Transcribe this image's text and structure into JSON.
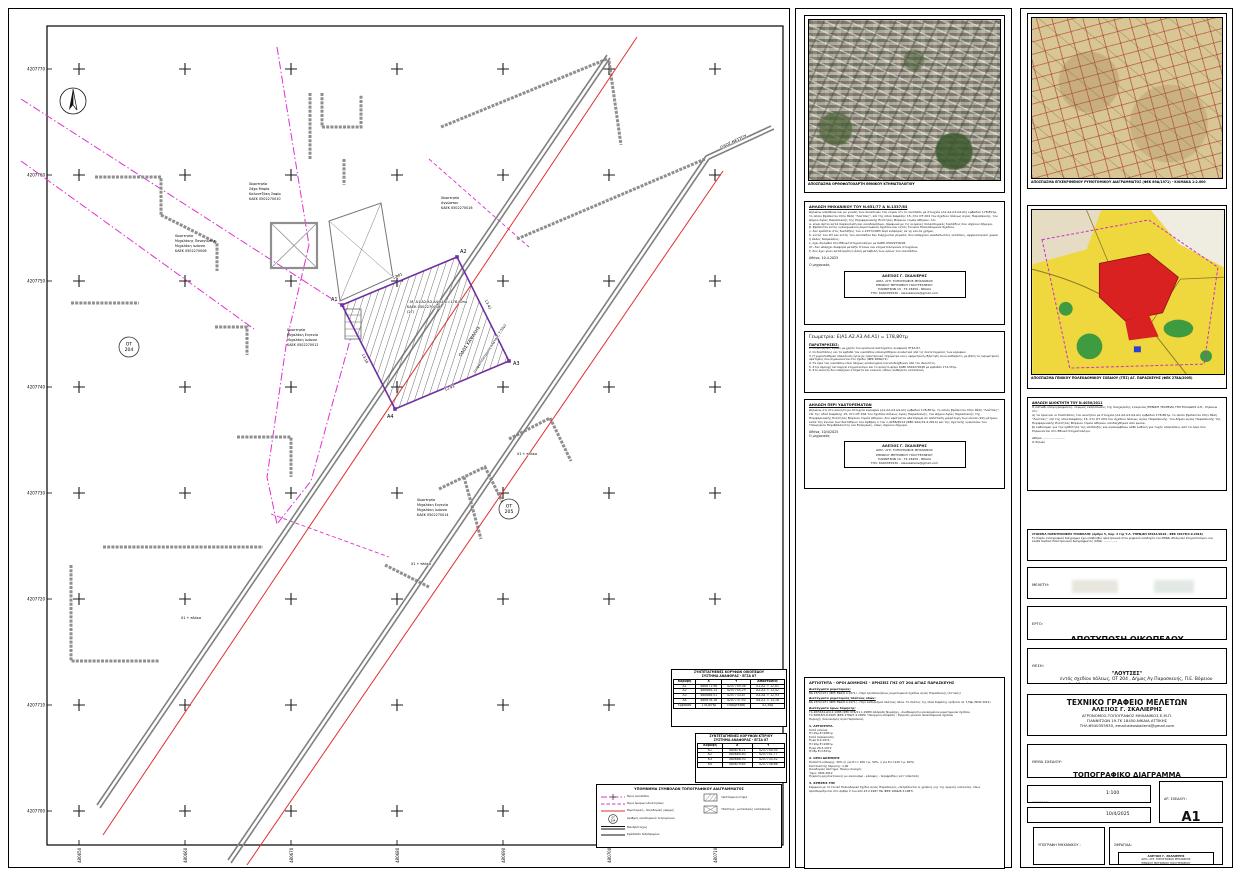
{
  "plan": {
    "y_ticks": [
      "4207770",
      "4207760",
      "4207750",
      "4207740",
      "4207730",
      "4207720",
      "4207710",
      "4207700"
    ],
    "x_ticks": [
      "480650",
      "480660",
      "480670",
      "480680",
      "480690",
      "480700",
      "480710"
    ],
    "ot1": {
      "l1": "ΟΤ",
      "l2": "204"
    },
    "ot2": {
      "l1": "ΟΤ",
      "l2": "205"
    },
    "vertices": [
      "Α1",
      "Α2",
      "Α3",
      "Α4"
    ],
    "dims": [
      "12,81",
      "13,42",
      "12,93",
      "13,18"
    ],
    "levels": [
      "Χ1 + πλάκα",
      "Χ1 + πλάκα",
      "Χ1 + πλάκα"
    ],
    "roads": {
      "r1": "ΟΔΟΣ ΚΑΨΑΛΗΣ",
      "r2": "(ασφαλτόστρωτη πλάτους 7,50μ)",
      "r3": "ΟΔΟΣ ΝΕΣΤΟΥ"
    },
    "plot": {
      "l1": "Γ.Μ. Α1.Α2.Α3.Α4.Α1 Ε=178,80τμ",
      "l2": "ΚΑΕΚ 0502270018",
      "l3": "(2Γ)"
    },
    "props": {
      "p10": [
        "Ιδιοκτησία",
        "Σάχα Μαρία",
        "Καλαντζάκη Σοφία",
        "ΚΑΕΚ 0502270010"
      ],
      "p08": [
        "Ιδιοκτησία",
        "Μιχαλάκης Παναγιώτης",
        "Μιχαλάκη Ιωάννα",
        "ΚΑΕΚ 0502270008"
      ],
      "p16": [
        "Ιδιοκτησία",
        "Αγνώστου",
        "ΚΑΕΚ 0502270016"
      ],
      "p12": [
        "Ιδιοκτησία",
        "Μιχαλάκη Ευγενία",
        "Μιχαλάκη Ιωάννα",
        "ΚΑΕΚ 0502270012"
      ],
      "p14": [
        "Ιδιοκτησία",
        "Μιχαλάκη Ευγενία",
        "Μιχαλάκη Ιωάννα",
        "ΚΑΕΚ 0502270014"
      ]
    },
    "legend": {
      "title": "ΥΠΟΜΝΗΜΑ ΣΥΜΒΟΛΩΝ ΤΟΠΟΓΡΑΦΙΚΟΥ ΔΙΑΓΡΑΜΜΑΤΟΣ",
      "items": [
        "Όρια οικοπέδου",
        "Όρια όμορων ιδιοκτησιών",
        "Ρυμοτομική - Οικοδομική γραμμή",
        "Αριθμός οικοδομικού τετραγώνου",
        "Μανδρότοιχος",
        "Κράσπεδο πεζοδρομίου",
        "Υφιστάμενα κτίρια",
        "Υπόστεγα - μεταλλικές κατασκευές"
      ]
    },
    "t1": {
      "title1": "ΣΥΝΤΕΤΑΓΜΕΝΕΣ ΚΟΡΥΦΩΝ ΟΙΚΟΠΕΔΟΥ",
      "title2": "ΣΥΣΤΗΜΑ ΑΝΑΦΟΡΑΣ - ΕΓΣΑ 87",
      "h": [
        "Κορυφή",
        "Χ",
        "Υ",
        "Αποστάσεις"
      ],
      "rows": [
        [
          "Α1",
          "480671.98",
          "4207749.36",
          "Α1-Α2 = 12,81"
        ],
        [
          "Α2",
          "480684.13",
          "4207745.29",
          "Α2-Α3 = 13,42"
        ],
        [
          "Α3",
          "480688.51",
          "4207733.87",
          "Α3-Α4 = 12,93"
        ],
        [
          "Α4",
          "480676.16",
          "4207737.93",
          "Α4-Α1 = 13,18"
        ]
      ],
      "f": [
        "Εμβαδόν",
        "178,80τμ",
        "Περίμετρος",
        "52,34μ"
      ]
    },
    "t2": {
      "title1": "ΣΥΝΤΕΤΑΓΜΕΝΕΣ ΚΟΡΥΦΩΝ ΚΤΙΡΙΟΥ",
      "title2": "ΣΥΣΤΗΜΑ ΑΝΑΦΟΡΑΣ - ΕΓΣΑ 87",
      "h": [
        "Κορυφή",
        "Χ",
        "Υ"
      ],
      "rows": [
        [
          "Κ1",
          "480676.21",
          "4207744.95"
        ],
        [
          "Κ2",
          "480684.60",
          "4207741.77"
        ],
        [
          "Κ3",
          "480688.93",
          "4207735.52"
        ],
        [
          "Κ4",
          "480679.85",
          "4207738.66"
        ]
      ]
    }
  },
  "mid": {
    "photo_caption": "ΑΠΟΣΠΑΣΜΑ ΟΡΘΟΦΩΤΟΧΑΡΤΗ ΕΘΝΙΚΟΥ ΚΤΗΜΑΤΟΛΟΓΙΟΥ",
    "d1": {
      "title": "ΔΗΛΩΣΗ ΜΗΧΑΝΙΚΟΥ ΤΟΥ Ν.651/77 & Ν.1337/83",
      "body": "Δηλώνω υπεύθυνα και με γνώση των συνεπειών του νόμου ότι το οικόπεδο με στοιχεία (Α1.Α2.Α3.Α4.Α1) εμβαδού 178,80τμ, το οποίο βρίσκεται στην θέση \"Λούτσες\", επί της οδού Καψάλης 15, στο ΟΤ 204 του σχεδίου πόλεως Αγίας Παρασκευής, του Δήμου Αγίας Παρασκευής της Περιφερειακής Ενότητας Βόρειου τομέα Αθηνών, ότι:\nα. είναι άρτιο κατά παρέκκλιση και οικοδομήσιμο, σύμφωνα με τις κείμενες πολεοδομικές διατάξεις που ισχύουν σήμερα,\nβ. βρίσκεται εντός εγκεκριμένου ρυμοτομικού σχεδίου και εντός Γενικού Πολεοδομικού Σχεδίου,\nγ. δεν εμπίπτει στις διατάξεις του ν.1337/1983 περί εισφοράς σε γη και σε χρήμα,\nδ. εντός του ΟΤ και εντός του οικοπέδου δεν διέρχονται ρέματα, δεν υπάρχουν αναδασωτέες εκτάσεις, αρχαιολογικοί χώροι ή άλλες δεσμεύσεις,\nε. έχει δηλωθεί στο Εθνικό Κτηματολόγιο με ΚΑΕΚ 0502270018,\nστ. δεν υπάρχει διαφορά μεταξύ τίτλων και κτηματολογικών στοιχείων,\nζ. δεν έχει γίνει κατάτμηση ή άλλη μεταβολή των ορίων του οικοπέδου.",
      "date": "Αθήνα, 10.4.2025",
      "signer": "Ο μηχανικός"
    },
    "stamp": [
      "ΑΛΕΞΙΟΣ Γ. ΣΚΑΛΙΕΡΗΣ",
      "ΔΙΠΛ. ΑΓΡ. ΤΟΠΟΓΡΑΦΟΣ ΜΗΧΑΝΙΚΟΣ",
      "ΕΘΝΙΚΟΥ ΜΕΤΣΟΒΙΟΥ ΠΟΛΥΤΕΧΝΕΙΟΥ",
      "ΓΙΑΝΝΙΤΣΩΝ 19 - ΤΚ 18450 - ΝΙΚΑΙΑ",
      "ΤΗΛ: 6940355930 - alexskalieris@gmail.com"
    ],
    "geo": {
      "title": "Γεωμετρία: Ε(Α1.Α2.Α3.Α4.Α1) = 178,80τμ",
      "nt": "ΠΑΡΑΤΗΡΗΣΕΙΣ:",
      "notes": "1. Οι μετρήσεις έγιναν με χρήση του κρατικού συστήματος αναφοράς ΕΓΣΑ-87.\n2. Οι διαστάσεις και τα εμβαδά του οικοπέδου υπολογίσθηκαν αναλυτικά από τις συντεταγμένες των κορυφών.\n3. Η χωροσταθμική απεικόνιση έγινε με ηλεκτρονικό ταχύμετρο και η υψομετρική εξάρτηση είναι αυθαίρετη, με βάση τις υψομετρικές αφετηρίες που σημειώνονται στο σχέδιο (ΦΕΚ 268Δ/71).\n4. Τα όρια του οικοπέδου είναι πλήρως υλοποιημένα και υποδείχθηκαν από τον ιδιοκτήτη.\n5. Στην περιοχή λειτουργεί κτηματολόγιο και το ακίνητο φέρει ΚΑΕΚ 0502270018 με εμβαδόν 174,33τμ.\n6. Στο ακίνητο δεν υπάρχουν κτίσματα και κανενός είδους αυθαίρετη κατασκευή."
    },
    "d2": {
      "title": "ΔΗΛΩΣΗ ΠΕΡΙ ΥΔΑΤΟΡΕΜΑΤΩΝ",
      "body": "Δηλώνω ότι στο ακίνητο με στοιχεία κορυφών (Α1.Α2.Α3.Α4.Α1) εμβαδού 178,80τμ, το οποίο βρίσκεται στην θέση \"Λούτσες\", επί της οδού Καψάλης 15, στο ΟΤ 204 του σχεδίου πόλεως Αγίας Παρασκευής, του Δήμου Αγίας Παρασκευής της Περιφερειακής Ενότητας Βόρειου τομέα Αθηνών, δεν υφίσταται υδατόρεμα σε απόσταση μικρότερη των είκοσι (20) μέτρων, κατά την έννοια των διατάξεων του άρθρου 1 του ν.4258/2014 (ΦΕΚ 94Α/14.4.2014) και της σχετικής εγκυκλίου του Υπουργείου Περιβάλλοντος και Ενέργειας, όπως ισχύουν σήμερα.",
      "date": "Αθήνα, 10/4/2025",
      "signer": "Ο μηχανικός"
    },
    "terms": {
      "title": "ΑΡΤΙΟΤΗΤΑ - ΟΡΟΙ ΔΟΜΗΣΗΣ - ΧΡΗΣΕΙΣ ΓΗΣ ΟΤ 204 ΑΓΙΑΣ ΠΑΡΑΣΚΕΥΗΣ",
      "s1h": "Διατάγματα ρυμοτομίας:",
      "s1b": "ΒΔ 23/5/1971 (ΦΕΚ 89Δ/8.4.1971) - Περί τροποποιήσεως ρυμοτομικού σχεδίου Αγίας Παρασκευής (Αττικής)",
      "s2h": "Διατάγματα ρυμοτομίας πλάτους οδών:",
      "s2b": "ΒΔ 23/5/1971 (ΦΕΚ 89Δ/8.4.1971) - Περί καθορισμού πλάτους οδών. Το πλάτος της οδού Καψάλης ορίζεται σε 7,50μ (ΝΟΚ 2012)",
      "s3h": "Διατάγματα όρων δόμησης:",
      "s3b": "ΥΑ 48/5634-Δ/9.2.1988 (ΦΕΚ 97Δ/11.1.1988) Απόφαση Νομάρχη - Αναθεώρηση εγκεκριμένου ρυμοτομικού σχεδίου\nΥΑ 26818/5.8.2005 (ΦΕΚ 278Δ/7.4.2005) Υπουργική απόφαση - Έγκριση γενικού πολεοδομικού σχεδίου\nΠεριοχή: Συνοικισμός Αγία Παρασκευή",
      "s4h": "1. ΑΡΤΙΟΤΗΤΑ.",
      "s4b": "Κατά κανόνα:\nΠ=15μ    Ε=400τμ\nΚατά παρέκκλιση:\nΈγκρ 8.4.1971:\nΠ=10μ    Ε=200τμ\nΈγκρ 26.3.1971:\nΠ=8μ     Ε=150τμ",
      "s5h": "2. ΟΡΟΙ ΔΟΜΗΣΗΣ",
      "s5b": "Ποσοστό κάλυψης: 30% (ή για Ε<= 200 τ.μ. 50%, ή για Ε<=120 τ.μ. 60%)\nΣυντελεστής δόμησης: 1,00\nΟικοδομικό σύστημα: Πρώην συνεχές\nΎψος: ΝΟΚ 2012\nΈγκριση αρχιτεκτονικής με κανονισμό - κάλυψης - περιφράξεις κατ' επέκταση",
      "s6h": "3. ΧΡΗΣΕΙΣ ΓΗΣ",
      "s6b": "Σύμφωνα με το Γενικό Πολεοδομικό Σχέδιο Αγίας Παρασκευής, επιτρέπονται οι χρήσεις γης της αμιγούς κατοικίας, όπως προσδιορίζονται στο άρθρο 2 του από 23.2.1987 ΠΔ (ΦΕΚ 166Δ/6.3.1987)."
    }
  },
  "right": {
    "cap1": "ΑΠΟΣΠΑΣΜΑ ΕΓΚΕΚΡΙΜΕΝΟΥ ΡΥΜΟΤΟΜΙΚΟΥ ΔΙΑΓΡΑΜΜΑΤΟΣ (ΦΕΚ 89Δ/1971) - ΚΛΙΜΑΚΑ 1:2.000",
    "cap2": "ΑΠΟΣΠΑΣΜΑ ΓΕΝΙΚΟΥ ΠΟΛΕΟΔΟΜΙΚΟΥ ΣΧΕΔΙΟΥ (ΓΠΣ) ΑΓ. ΠΑΡΑΣΚΕΥΗΣ (ΦΕΚ 278Δ/2005)",
    "od": {
      "title": "ΔΗΛΩΣΗ ΙΔΙΟΚΤΗΤΗ ΤΟΥ Ν.4030/2011",
      "body": "Ο κάτωθι υπογεγραμμένος, νόμιμος εκπρόσωπος της διαχείρισης εταιρείας ΕΘΝΙΚΗ ΤΡΑΠΕΖΑ ΤΗΣ ΕΛΛΑΔΟΣ Α.Ε., δηλώνω ότι:\nα) τα όρια και οι διαστάσεις του ακινήτου με στοιχεία (Α1.Α2.Α3.Α4.Α1) εμβαδού 178,80τμ, το οποίο βρίσκεται στην θέση \"Λούτσες\", επί της οδού Καψάλης 15, στο ΟΤ 204 του σχεδίου πόλεως Αγίας Παρασκευής, του Δήμου Αγίας Παρασκευής της Περιφερειακής Ενότητας Βόρειου τομέα Αθηνών, υποδείχθηκαν από εμένα,\nβ) ευθύνομαι για την ορθότητα της υπόδειξης και αναλαμβάνω κάθε ευθύνη για τυχόν αποκλίσεις από τα όρια που δηλώνονται στο Εθνικό Κτηματολόγιο.",
      "date": "Αθήνα, .......................",
      "signer": "Ο δηλών"
    },
    "sub": {
      "title": "ΣΤΟΙΧΕΙΑ ΗΛΕΚΤΡΟΝΙΚΗΣ ΥΠΟΒΟΛΗΣ (άρθρο 5, παρ. 4 της Υ.Α. ΥΠΕΝ/ΔΠ 64014/2018 - ΦΕΚ 3017Β/4.9.2018)",
      "body": "Το παρόν τοπογραφικό διάγραμμα έχει υποβληθεί ηλεκτρονικά στον ψηφιακό υποδοχέα του ΝΠΔΔ «Ελληνικό Κτηματολόγιο» και έλαβε Κωδικό Ηλεκτρονικού Διαγράμματος (ΚΗΔ): ..............."
    },
    "tb": {
      "meleti_label": "ΜΕΛΕΤΗ:",
      "ergo_label": "ΕΡΓΟ:",
      "ergo": "ΑΠΟΤΥΠΩΣΗ ΟΙΚΟΠΕΔΟΥ",
      "thesi_label": "ΘΕΣΗ:",
      "thesi1": "\"ΛΟΥΤΣΕΣ\"",
      "thesi2": "εντός σχεδίου πόλεως, ΟΤ 204 , Δήμος Αγ.Παρασκευής, Π.Ε. Βόρειου τομέα Αθηνών",
      "thesi3": "Οδός Καψάλης 15",
      "office1": "ΤΕΧΝΙΚΟ ΓΡΑΦΕΙΟ ΜΕΛΕΤΩΝ",
      "office2": "ΑΛΕΞΙΟΣ Γ. ΣΚΑΛΙΕΡΗΣ",
      "office3": "ΑΓΡΟΝΟΜΟΣ-ΤΟΠΟΓΡΑΦΟΣ ΜΗΧΑΝΙΚΟΣ Ε.Μ.Π.",
      "office4": "ΓΙΑΝΝΙΤΣΩΝ 19-ΤΚ 18450-ΝΙΚΑΙΑ ΑΤΤΙΚΗΣ",
      "office5": "ΤΗΛ:6940355930, email:alexskalieris@gmail.com",
      "thema_label": "ΘΕΜΑ ΣΧΕΔΙΟΥ:",
      "thema": "ΤΟΠΟΓΡΑΦΙΚΟ ΔΙΑΓΡΑΜΜΑ",
      "klimaka_label": "ΚΛΙΜΑΚΑ:",
      "klimaka": "1:100",
      "imer_label": "ΗΜΕΡΟΜΗΝΙΑ",
      "imer": "10/4/2025",
      "ar_label": "ΑΡ. ΣΧΕΔΙΟΥ :",
      "ar": "A1",
      "ypog_label": "ΥΠΟΓΡΑΦΗ ΜΗΧΑΝΙΚΟΥ :",
      "sfr_label": "ΣΦΡΑΓΙΔΑ:"
    }
  }
}
